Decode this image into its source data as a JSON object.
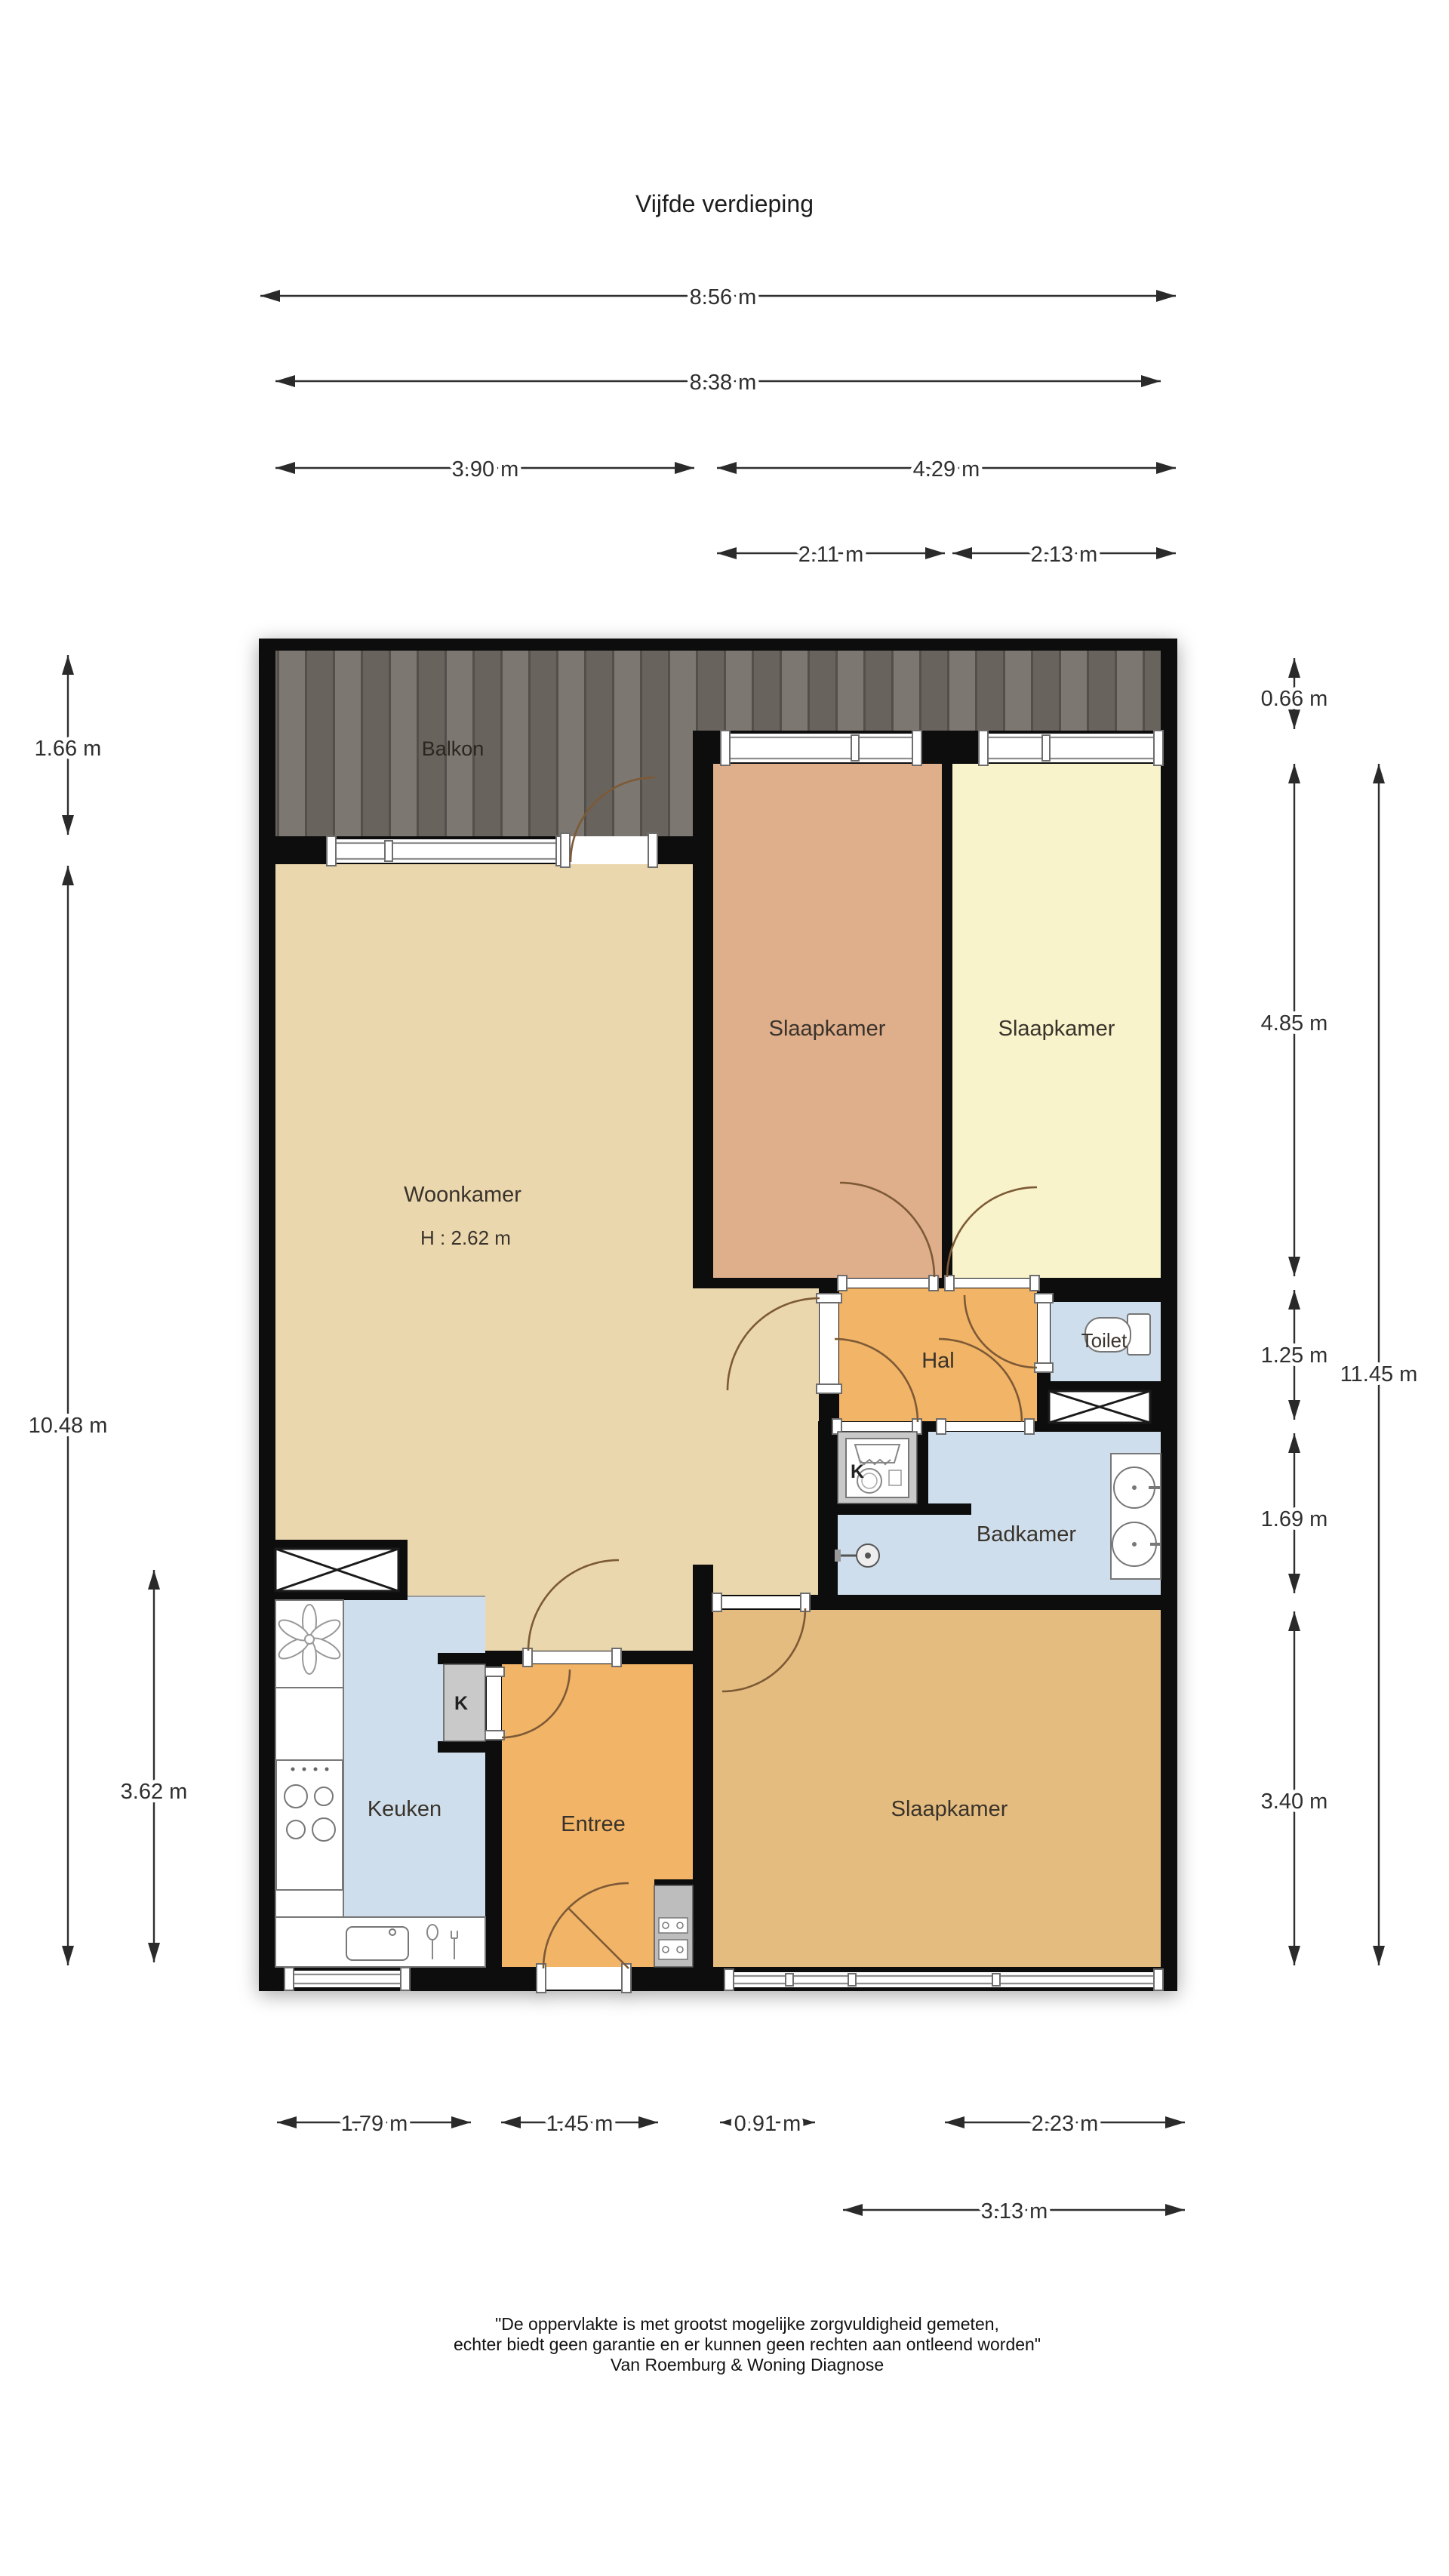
{
  "title": "Vijfde verdieping",
  "rooms": {
    "balkon": "Balkon",
    "woonkamer": "Woonkamer",
    "woonkamer_height": "H : 2.62 m",
    "slaapkamer_top_left": "Slaapkamer",
    "slaapkamer_top_right": "Slaapkamer",
    "slaapkamer_bottom": "Slaapkamer",
    "hal": "Hal",
    "toilet": "Toilet",
    "badkamer": "Badkamer",
    "keuken": "Keuken",
    "entree": "Entree",
    "closet_badkamer": "K",
    "closet_entree": "K"
  },
  "dimensions": {
    "top": {
      "total": "8.56 m",
      "inner": "8.38 m",
      "left_part": "3.90 m",
      "right_part": "4.29 m",
      "bedroom_left": "2.11 m",
      "bedroom_right": "2.13 m"
    },
    "bottom": {
      "keuken": "1.79 m",
      "entree": "1.45 m",
      "door": "0.91 m",
      "window": "2.23 m",
      "slaapkamer": "3.13 m"
    },
    "left": {
      "balkon": "1.66 m",
      "woonkamer": "10.48 m",
      "keuken": "3.62 m"
    },
    "right": {
      "balkon": "0.66 m",
      "slaapkamers": "4.85 m",
      "hal": "1.25 m",
      "badkamer": "1.69 m",
      "slaapkamer_bottom": "3.40 m",
      "total": "11.45 m"
    }
  },
  "footer": {
    "line1": "\"De oppervlakte is met grootst mogelijke zorgvuldigheid gemeten,",
    "line2": "echter biedt geen garantie en er kunnen geen rechten aan ontleend worden\"",
    "line3": "Van Roemburg & Woning Diagnose"
  },
  "colors": {
    "wall": "#0d0d0d",
    "woonkamer": "#EBD7AE",
    "slaapkamer_salmon": "#DFAE8B",
    "slaapkamer_yellow": "#F8F3CA",
    "hal_entree": "#F2B467",
    "slaapkamer_tan": "#E5BC7F",
    "natte_ruimte": "#CFDEEC",
    "balkon_wood": "#76726C",
    "kast_gray": "#C9C9C9",
    "dimension": "#2F2F2F"
  }
}
